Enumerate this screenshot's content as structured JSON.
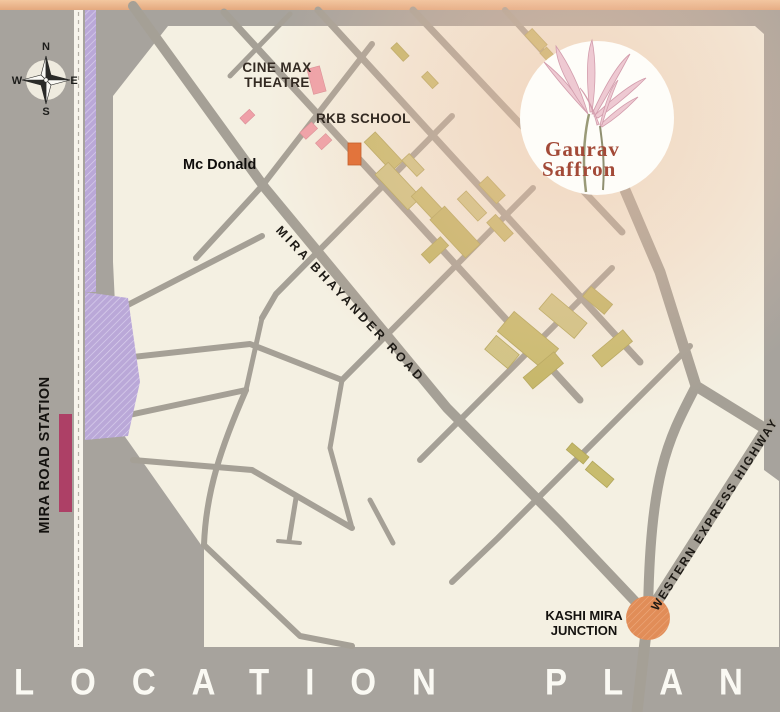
{
  "title_band": {
    "location_plan": "LOCATION PLAN"
  },
  "compass": {
    "north": "N",
    "east": "E",
    "south": "S",
    "west": "W"
  },
  "logo": {
    "name_line1": "Gaurav",
    "name_line2": "Saffron",
    "text_color": "#a34a38"
  },
  "map": {
    "landmarks": {
      "cinemax_line1": "CINE MAX",
      "cinemax_line2": "THEATRE",
      "rkb_school": "RKB SCHOOL",
      "mcdonald": "Mc Donald",
      "kashi_line1": "KASHI MIRA",
      "kashi_line2": "JUNCTION",
      "station": "MIRA ROAD STATION"
    },
    "roads": {
      "mira_bhayander": "MIRA BHAYANDER ROAD",
      "western_express": "WESTERN EXPRESS HIGHWAY"
    },
    "colors": {
      "canvas_bg": "#a7a39d",
      "map_bg": "#f4f0e2",
      "road": "#a5a096",
      "top_strip": "#ecb890",
      "railway_line": "#baa8d8",
      "station_platform": "#ad4066",
      "building": "#c8bc6e",
      "pink_building": "#efa0a8",
      "site_marker": "#e2743c",
      "junction_marker": "#e18d58"
    }
  }
}
